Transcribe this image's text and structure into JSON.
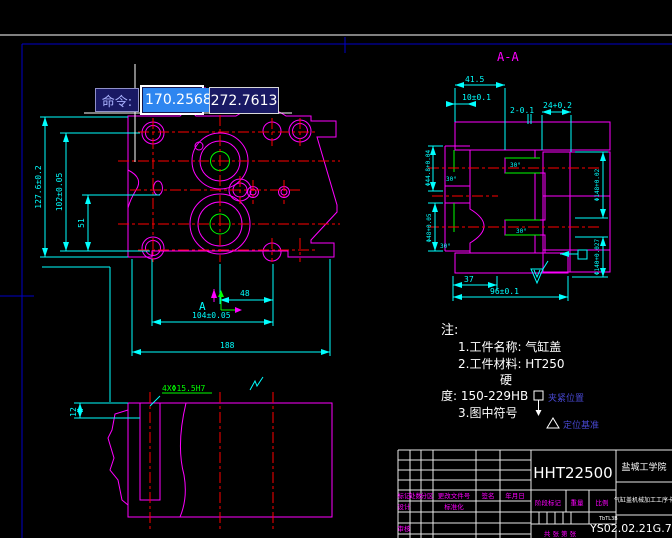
{
  "command_tooltip": {
    "label": "命令:",
    "x_value": "170.2568",
    "y_value": "272.7613"
  },
  "main_view": {
    "dim_127": "127.6±0.2",
    "dim_102": "102±0.05",
    "dim_51": "51",
    "dim_48": "48",
    "dim_104": "104±0.05",
    "dim_188": "188",
    "section_label": "A"
  },
  "section_view": {
    "title": "A-A",
    "dim_415": "41.5",
    "dim_10": "10±0.1",
    "dim_2": "2-0.1",
    "dim_24": "24+0.2",
    "dim_d448": "Φ44.8+0.04",
    "dim_d48": "Φ48+0.05",
    "dim_d148": "Φ148+0.02",
    "dim_d140": "Φ140+0.027",
    "dim_37": "37",
    "dim_96": "96±0.1",
    "angle_30": "30°"
  },
  "bottom_view": {
    "dim_12": "12",
    "dim_holes": "4XΦ15.5H7"
  },
  "notes": {
    "heading": "注:",
    "line1": "1.工件名称: 气缸盖",
    "line2": "2.工件材料: HT250",
    "line3": "硬",
    "line4": "度: 150-229HB",
    "line5": "3.图中符号",
    "clamp_label": "夹紧位置",
    "datum_label": "定位基准"
  },
  "title_block": {
    "part_code": "HHT22500",
    "org_name": "盐城工学院",
    "doc_title": "气缸盖机械加工工序卡",
    "drawing_no": "YS02.02.21G.7",
    "misc_small": "TbTL3B",
    "col_mark": "标记",
    "col_count": "处数",
    "col_zone": "分区",
    "col_file": "更改文件号",
    "col_sign": "签名",
    "col_date": "年月日",
    "row_design": "设计",
    "row_standard": "标准化",
    "row_check": "审核",
    "stage_label": "阶段标记",
    "weight_label": "重量",
    "scale_label": "比例",
    "sheet_label": "共 张 第 张"
  }
}
